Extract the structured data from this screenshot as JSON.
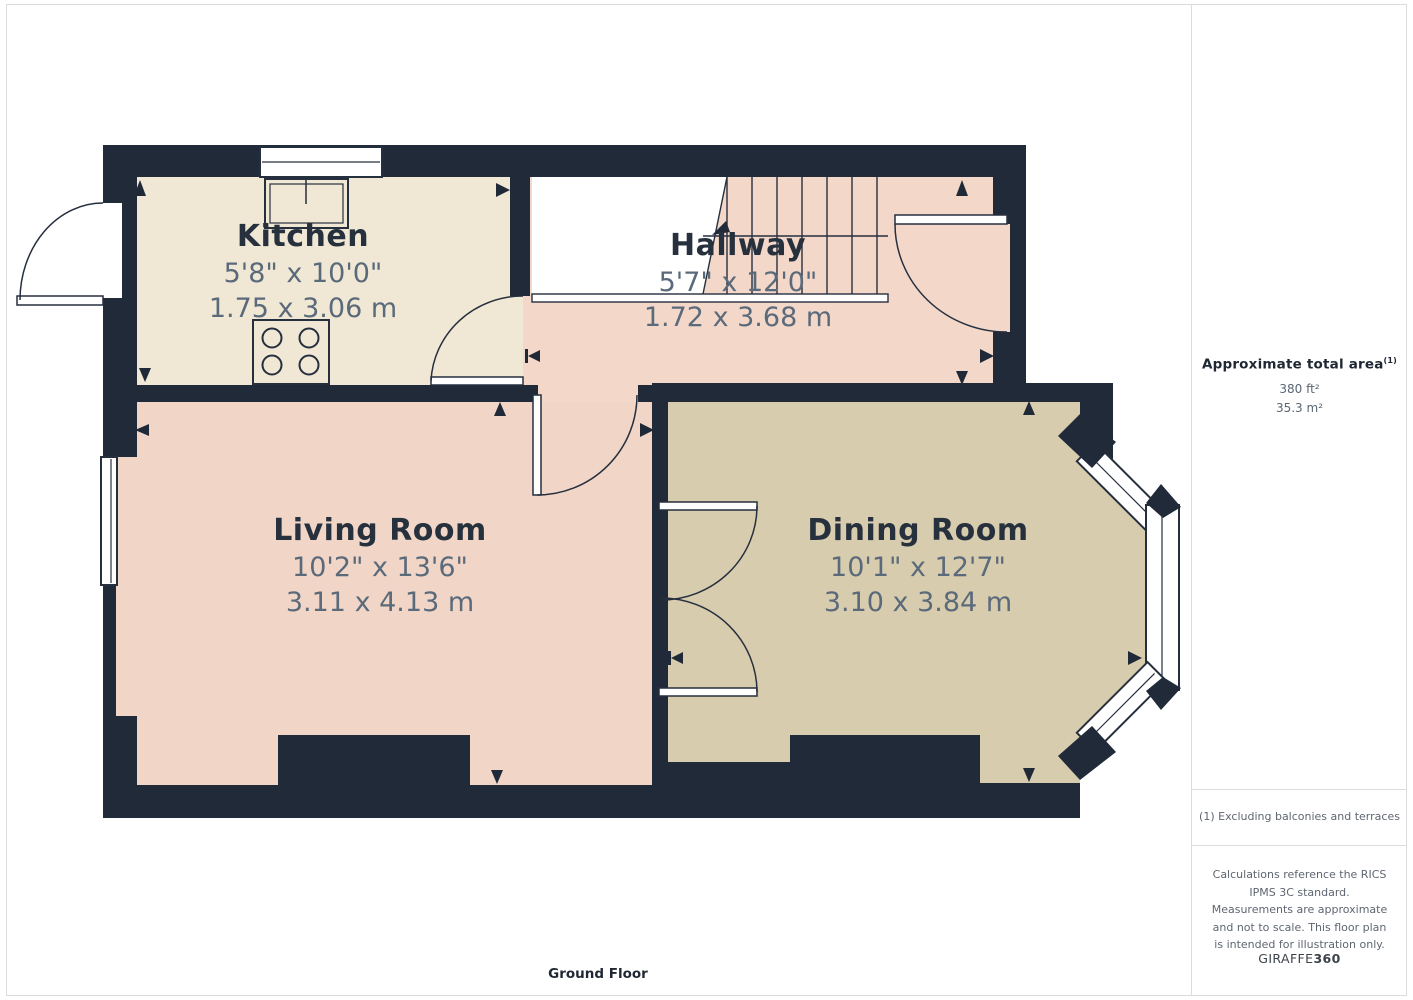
{
  "palette": {
    "wall": "#202a38",
    "kitchen_floor": "#f0e8d5",
    "hallway_floor": "#f3d8ca",
    "living_floor": "#f1d6c8",
    "dining_floor": "#d8ccae",
    "room_name_text": "#27313e",
    "dimension_text": "#5b6a7a",
    "note_text": "#5f6671",
    "outline": "#262f3e",
    "page_border": "#dcdcdc"
  },
  "rooms": [
    {
      "name": "Kitchen",
      "imperial": "5'8\" x 10'0\"",
      "metric": "1.75 x 3.06 m"
    },
    {
      "name": "Hallway",
      "imperial": "5'7\" x 12'0\"",
      "metric": "1.72 x 3.68 m"
    },
    {
      "name": "Living Room",
      "imperial": "10'2\" x 13'6\"",
      "metric": "3.11 x 4.13 m"
    },
    {
      "name": "Dining Room",
      "imperial": "10'1\" x 12'7\"",
      "metric": "3.10 x 3.84 m"
    }
  ],
  "sidebar": {
    "area_title": "Approximate total area",
    "area_title_superscript": "(1)",
    "area_imperial": "380 ft²",
    "area_metric": "35.3 m²",
    "footnote": "(1) Excluding balconies and terraces",
    "disclaimer": "Calculations reference the RICS IPMS 3C standard. Measurements are approximate and not to scale. This floor plan is intended for illustration only.",
    "brand_name": "GIRAFFE",
    "brand_suffix": "360"
  },
  "footer": {
    "floor_label": "Ground Floor"
  }
}
